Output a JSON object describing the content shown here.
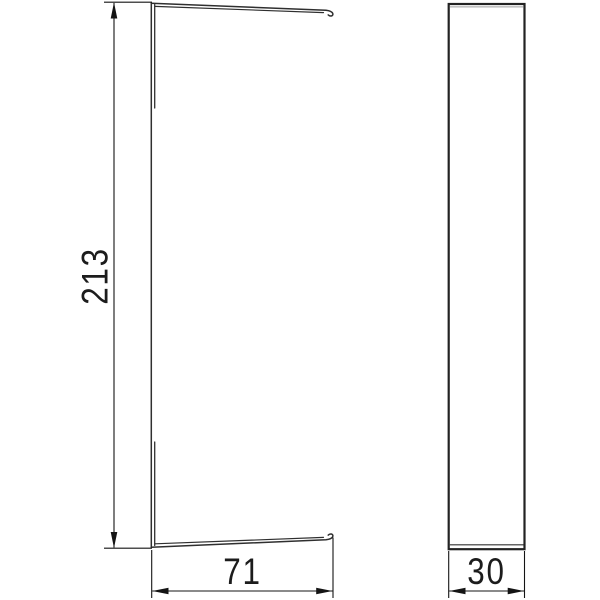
{
  "drawing": {
    "type": "technical-dimension-drawing",
    "part": "cover-profile-end-piece",
    "front_view": {
      "height_dimension": "213",
      "width_dimension": "71"
    },
    "side_view": {
      "width_dimension": "30"
    }
  },
  "colors": {
    "background": "#ffffff",
    "part_outline": "#2f2f2f",
    "dimension_line": "#141414",
    "text": "#1c1c1c",
    "accent_gray": "#c2c2c2"
  }
}
